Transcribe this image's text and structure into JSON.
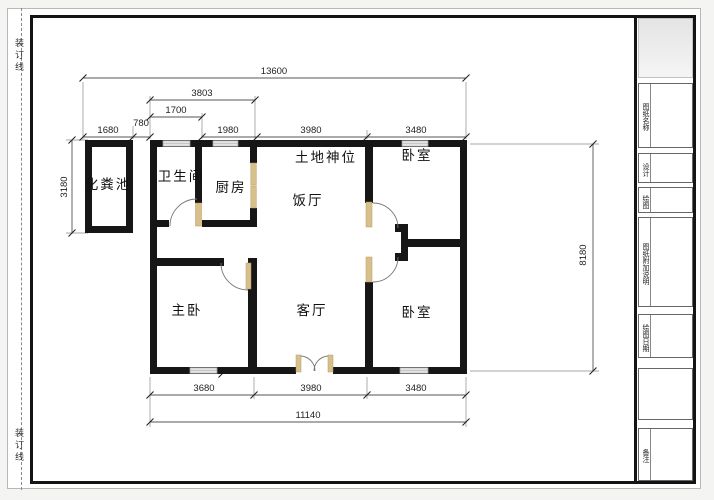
{
  "page": {
    "binding_line_label": "装订线"
  },
  "rooms": {
    "septic": "化粪池",
    "bath": "卫生间",
    "kitchen": "厨房",
    "shrine": "土地神位",
    "dining": "饭厅",
    "bedroom_top": "卧室",
    "master": "主卧",
    "living": "客厅",
    "bedroom_bottom": "卧室"
  },
  "dims": {
    "total_width": "13600",
    "w3803": "3803",
    "w1700": "1700",
    "w1680": "1680",
    "w780": "780",
    "w1980": "1980",
    "w3980_top": "3980",
    "w3480_top": "3480",
    "h3180": "3180",
    "h2980": "2980",
    "h1220": "1220",
    "h8180": "8180",
    "h3980_master": "3980",
    "w3680": "3680",
    "w3980_bottom": "3980",
    "w3480_bottom": "3480",
    "w11140": "11140"
  },
  "title_block": {
    "drawing_name": "图纸名称",
    "design": "设计",
    "draft": "绘图",
    "notes": "图纸附加说明",
    "date": "绘图日期",
    "remark": "备注"
  },
  "colors": {
    "wall": "#161616",
    "door_leaf": "#d8c08c",
    "window_fill": "#e3e3e3",
    "dim_line": "#555555"
  }
}
